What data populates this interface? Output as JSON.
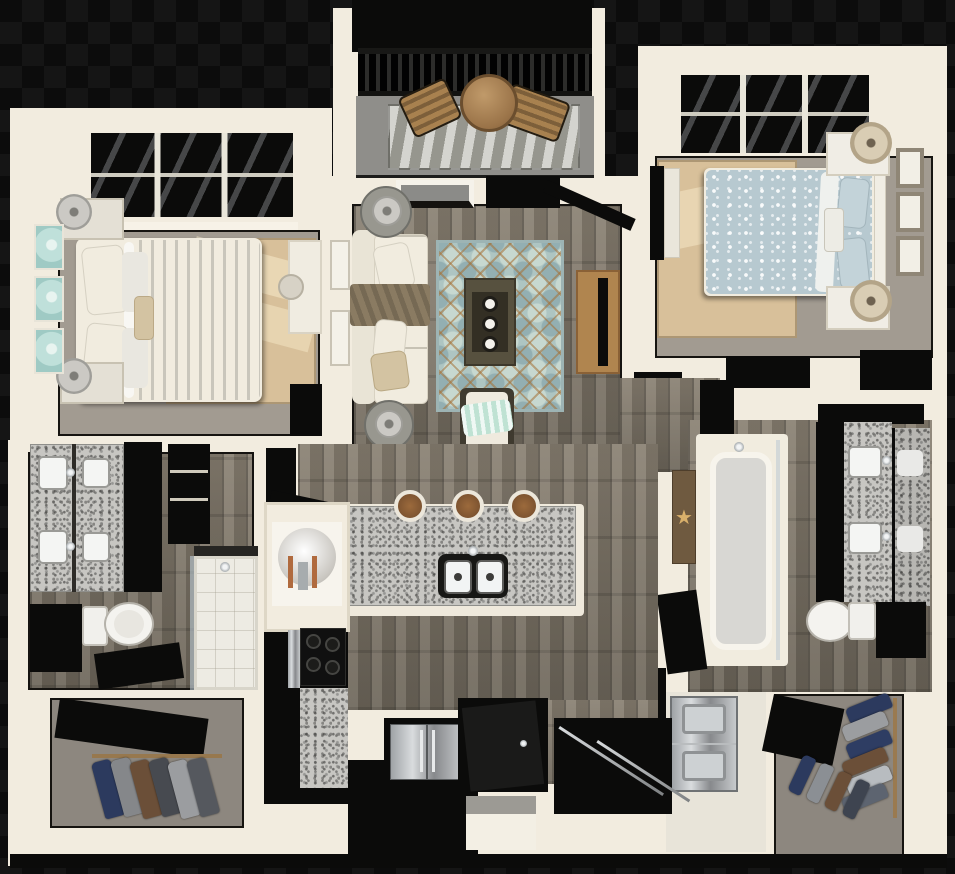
{
  "scene": {
    "type": "3d-floor-plan",
    "description": "Top-down 3D rendering of a two-bedroom, two-bathroom apartment with balcony, open kitchen, walk-in closets and stacked laundry",
    "rooms": [
      {
        "name": "balcony",
        "furniture": [
          "round bistro table",
          "two wood sling chairs",
          "striped outdoor rug",
          "black railing"
        ]
      },
      {
        "name": "bedroom-1",
        "furniture": [
          "white striped queen bed",
          "two nightstands with gray lamps",
          "three teal wall canvases",
          "jute rug",
          "white desk"
        ]
      },
      {
        "name": "living-room",
        "furniture": [
          "cream sofa with taupe throw",
          "two round side tables with lamps",
          "teal trellis rug",
          "dark coffee table with three candles",
          "accent chair with mint throw",
          "wood tv console with flat tv",
          "two wall frames"
        ]
      },
      {
        "name": "bedroom-2",
        "furniture": [
          "blue floral queen bed",
          "two white nightstands with tan lamps",
          "three framed prints",
          "jute rug",
          "tv on dresser"
        ]
      },
      {
        "name": "bathroom-1",
        "furniture": [
          "double granite vanity",
          "dark cabinets",
          "linen shelves",
          "toilet",
          "glass shower"
        ]
      },
      {
        "name": "kitchen",
        "furniture": [
          "granite island with double sink",
          "three bar stools",
          "water heater closet",
          "black cooktop",
          "stainless french-door refrigerator",
          "granite counter"
        ]
      },
      {
        "name": "bathroom-2",
        "furniture": [
          "double granite vanity with mirror",
          "tub shower with glass",
          "toilet",
          "starfish wall decor",
          "dark cabinet"
        ]
      },
      {
        "name": "walk-in-closet-1",
        "furniture": [
          "hanging clothes",
          "closet rod"
        ]
      },
      {
        "name": "walk-in-closet-2",
        "furniture": [
          "hanging clothes on two rods"
        ]
      },
      {
        "name": "laundry-closet",
        "furniture": [
          "stacked washer and dryer"
        ]
      },
      {
        "name": "entry",
        "furniture": [
          "open front door",
          "coat closet with sliding doors"
        ]
      }
    ]
  },
  "icons": {
    "starfish": "★"
  },
  "palette": {
    "bg-check-a": "#151515",
    "bg-check-b": "#0c0c0c",
    "wall": "#f2ecdf",
    "wall-shade": "#e1dac8",
    "ink": "#0b0b0a",
    "concrete": "#8f8e8a",
    "carpet": "#a29b91",
    "carpet-dark": "#8d877f",
    "wood-a": "#8a8173",
    "wood-b": "#6e675b",
    "granite": "#c7c6c2",
    "jute": "#d8c09a",
    "teal-a": "#c7d8d0",
    "teal-b": "#93afb2",
    "rug-base": "#aec5c2",
    "teal-art": "#bfe0da",
    "white-soft": "#f1ecdf",
    "taupe": "#8a7b62",
    "tan-pillow": "#d3c3a2",
    "mint": "#bfe2d3",
    "wood-furn": "#b0854f",
    "table-dark": "#57513f",
    "blue-bed": "#b7c9d0",
    "lamp-tan": "#b3a488",
    "copper": "#b06a3e",
    "star": "#d9b06b",
    "railing": "#2c2c2a",
    "navy": "#2c3a5e",
    "brown": "#6b4f38",
    "charcoal": "#474a50",
    "gray-cloth": "#9b9da0",
    "slate": "#55585e"
  }
}
